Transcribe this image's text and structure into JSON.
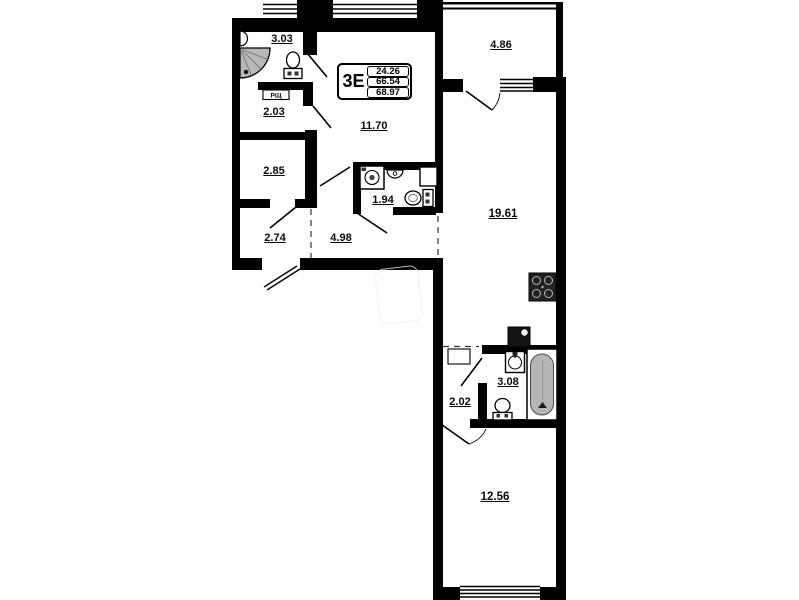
{
  "plan": {
    "unit_type": "3Е",
    "areas_table": {
      "living_area": "24.26",
      "apartment_area": "66.54",
      "total_area": "68.97"
    },
    "rooms": [
      {
        "id": "bathroom-top",
        "area": "3.03"
      },
      {
        "id": "storage",
        "area": "2.03"
      },
      {
        "id": "wardrobe",
        "area": "2.85"
      },
      {
        "id": "entry-hall",
        "area": "2.74"
      },
      {
        "id": "corridor",
        "area": "4.98"
      },
      {
        "id": "bedroom-top",
        "area": "11.70"
      },
      {
        "id": "wc",
        "area": "1.94"
      },
      {
        "id": "balcony",
        "area": "4.86"
      },
      {
        "id": "kitchen-living",
        "area": "19.61"
      },
      {
        "id": "bathroom-bottom",
        "area": "3.08"
      },
      {
        "id": "hall-bottom",
        "area": "2.02"
      },
      {
        "id": "bedroom-bottom",
        "area": "12.56"
      }
    ],
    "labels": {
      "electrical_panel": "РЩ"
    },
    "colors": {
      "wall": "#000000",
      "fixture_gray": "#b5b5b5",
      "background": "#ffffff"
    }
  }
}
